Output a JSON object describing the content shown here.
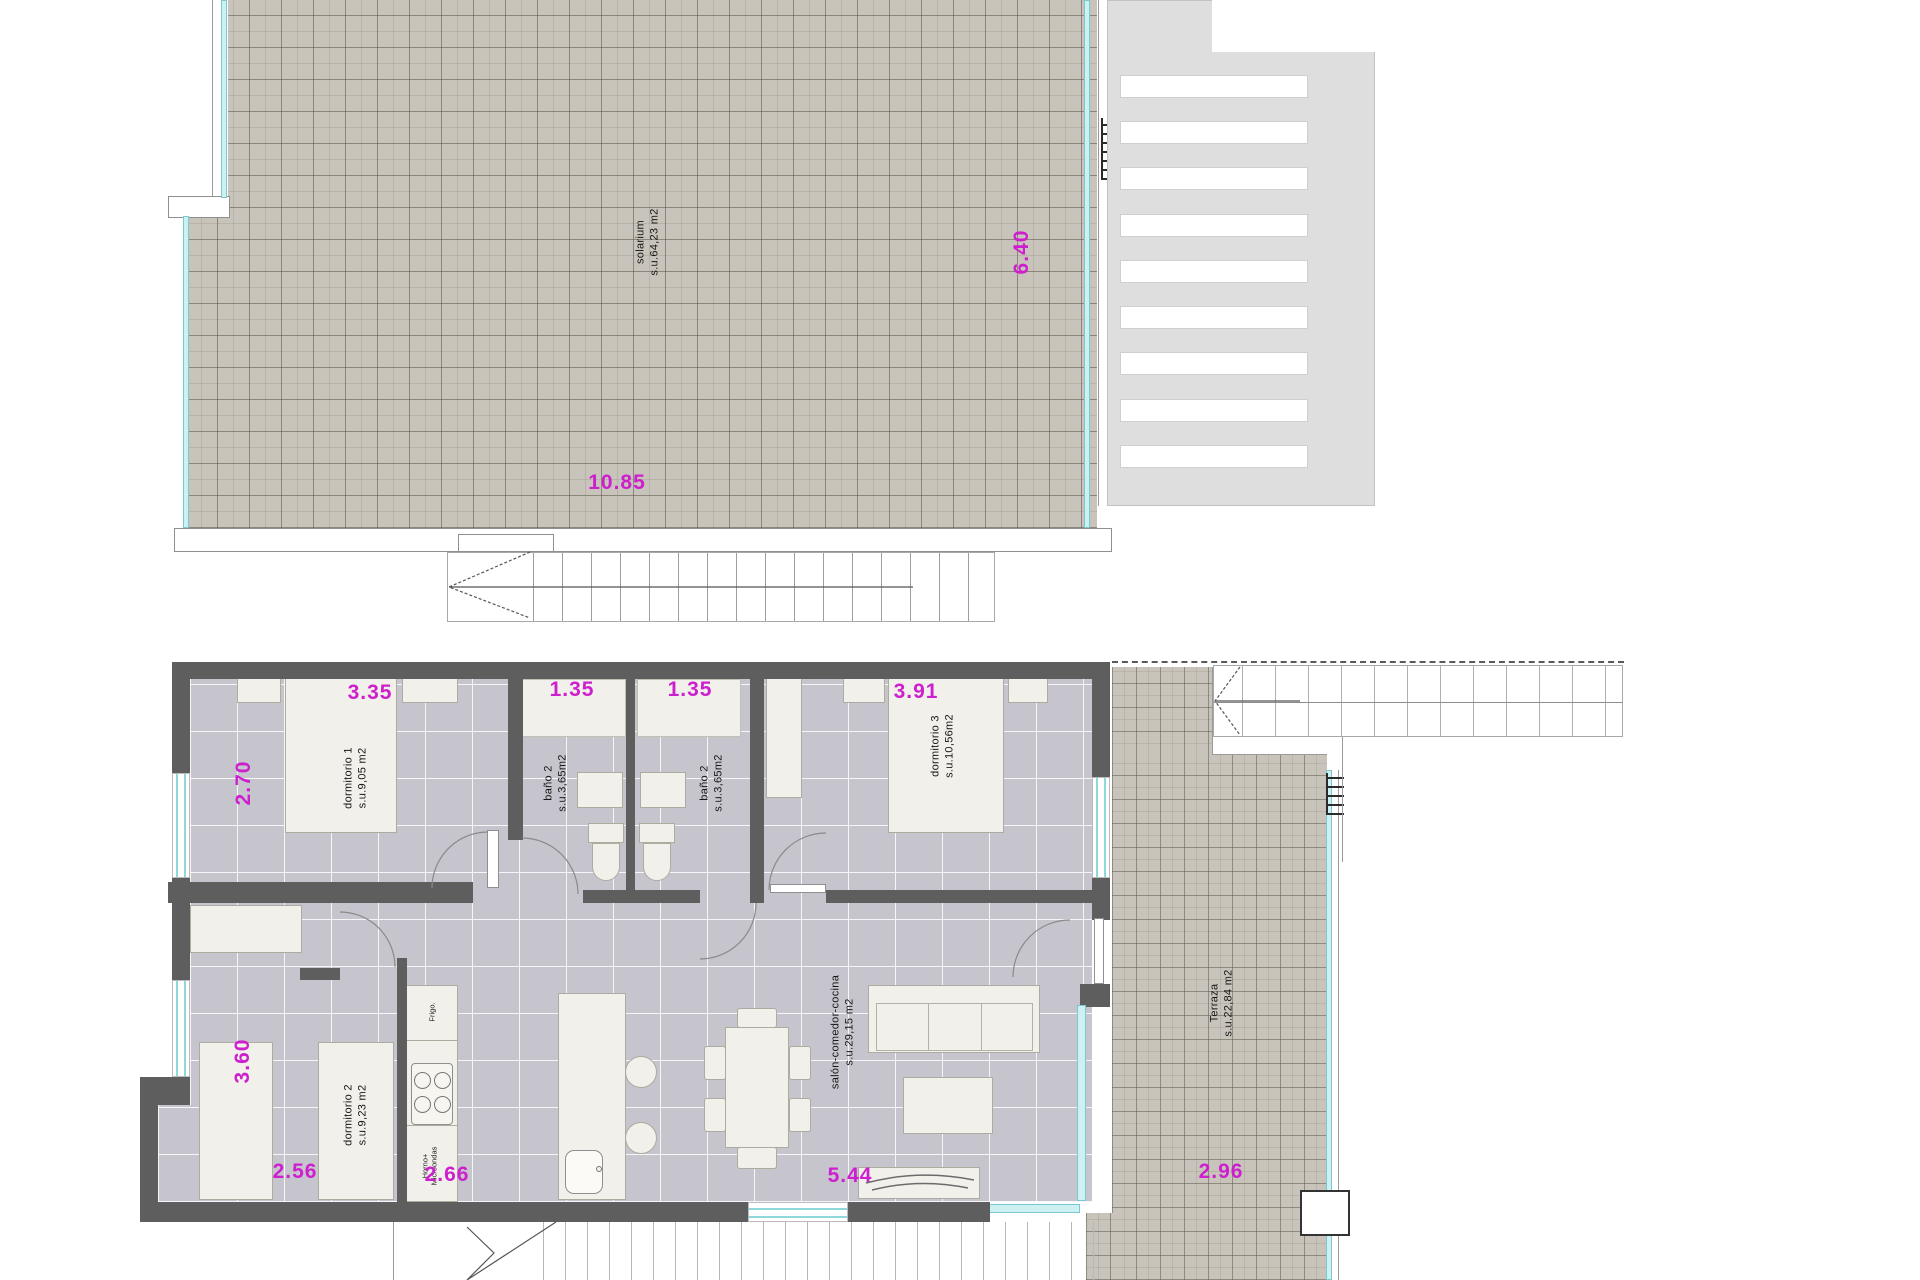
{
  "plan": {
    "upper": {
      "solarium": {
        "name": "solarium",
        "area": "s.u.64,23 m2"
      },
      "dims": {
        "width": "10.85",
        "height": "6.40"
      }
    },
    "lower": {
      "dormitorio1": {
        "name": "dormitorio 1",
        "area": "s.u.9,05 m2",
        "dim_top": "3.35",
        "dim_left": "2.70"
      },
      "banoA": {
        "name": "baño 2",
        "area": "s.u.3,65m2",
        "dim_top": "1.35"
      },
      "banoB": {
        "name": "baño 2",
        "area": "s.u.3,65m2",
        "dim_top": "1.35"
      },
      "dormitorio3": {
        "name": "dormitorio 3",
        "area": "s.u.10,56m2",
        "dim_top": "3.91"
      },
      "dormitorio2": {
        "name": "dormitorio 2",
        "area": "s.u.9,23 m2",
        "dim_left": "3.60",
        "dim_bottom": "2.56"
      },
      "salon": {
        "name": "salón-comedor-cocina",
        "area": "s.u.29,15 m2",
        "dim_bottom": "5.44"
      },
      "terraza": {
        "name": "Terraza",
        "area": "s.u.22,84 m2",
        "dim_bottom": "2.96"
      },
      "kitchen": {
        "fridge": "Frigo.",
        "oven_line1": "Horno+",
        "oven_line2": "Microondas",
        "dim_bottom": "2.66"
      }
    }
  },
  "colors": {
    "dimension": "#ce1fce",
    "wall": "#5e5e5e",
    "glass": "#cdf0f3",
    "tile_beige": "#c8c4bb",
    "floor": "#c6c5cd"
  }
}
